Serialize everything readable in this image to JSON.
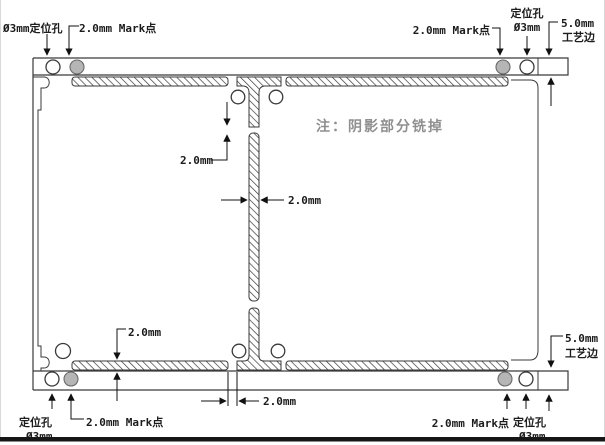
{
  "drawing": {
    "kind": "pcb-panelization-drawing",
    "note": "注：阴影部分铣掉"
  },
  "labels": {
    "top_left_hole": "Ø3mm定位孔",
    "top_left_mark": "2.0mm Mark点",
    "top_right_mark": "2.0mm Mark点",
    "top_right_hole_name": "定位孔",
    "top_right_hole_size": "Ø3mm",
    "top_right_edge_size": "5.0mm",
    "top_right_edge_name": "工艺边",
    "bottom_left_hole_name": "定位孔",
    "bottom_left_hole_size": "Ø3mm",
    "bottom_left_mark": "2.0mm Mark点",
    "bottom_right_mark": "2.0mm Mark点",
    "bottom_right_hole_name": "定位孔",
    "bottom_right_hole_size": "Ø3mm",
    "bottom_right_edge_size": "5.0mm",
    "bottom_right_edge_name": "工艺边"
  },
  "dimensions": {
    "top_tab_gap": "2.0mm",
    "slot_width": "2.0mm",
    "bottom_slot_height": "2.0mm",
    "bottom_tab_gap": "2.0mm"
  },
  "colors": {
    "line": "#3a3a3a",
    "dimension_line": "#111111",
    "mark_point_fill": "#b5b5b5",
    "note_text": "#8f8f8f",
    "hatch": "#3a3a3a",
    "bottom_bar": "#161616"
  }
}
